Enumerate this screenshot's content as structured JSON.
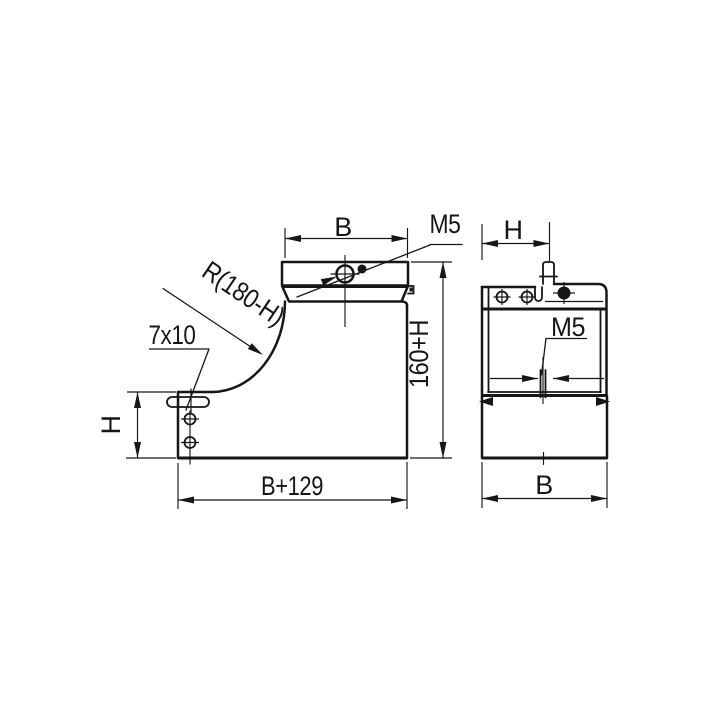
{
  "drawing": {
    "background_color": "#ffffff",
    "stroke_color": "#161616",
    "front_view": {
      "dim_width_top": "B",
      "thread_label": "M5",
      "radius_label": "R(180-H)",
      "slot_label": "7x10",
      "dim_height_left": "H",
      "dim_height_right": "160+H",
      "dim_width_bottom": "B+129"
    },
    "side_view": {
      "dim_width_top": "H",
      "thread_label": "M5",
      "dim_width_bottom": "B"
    }
  }
}
